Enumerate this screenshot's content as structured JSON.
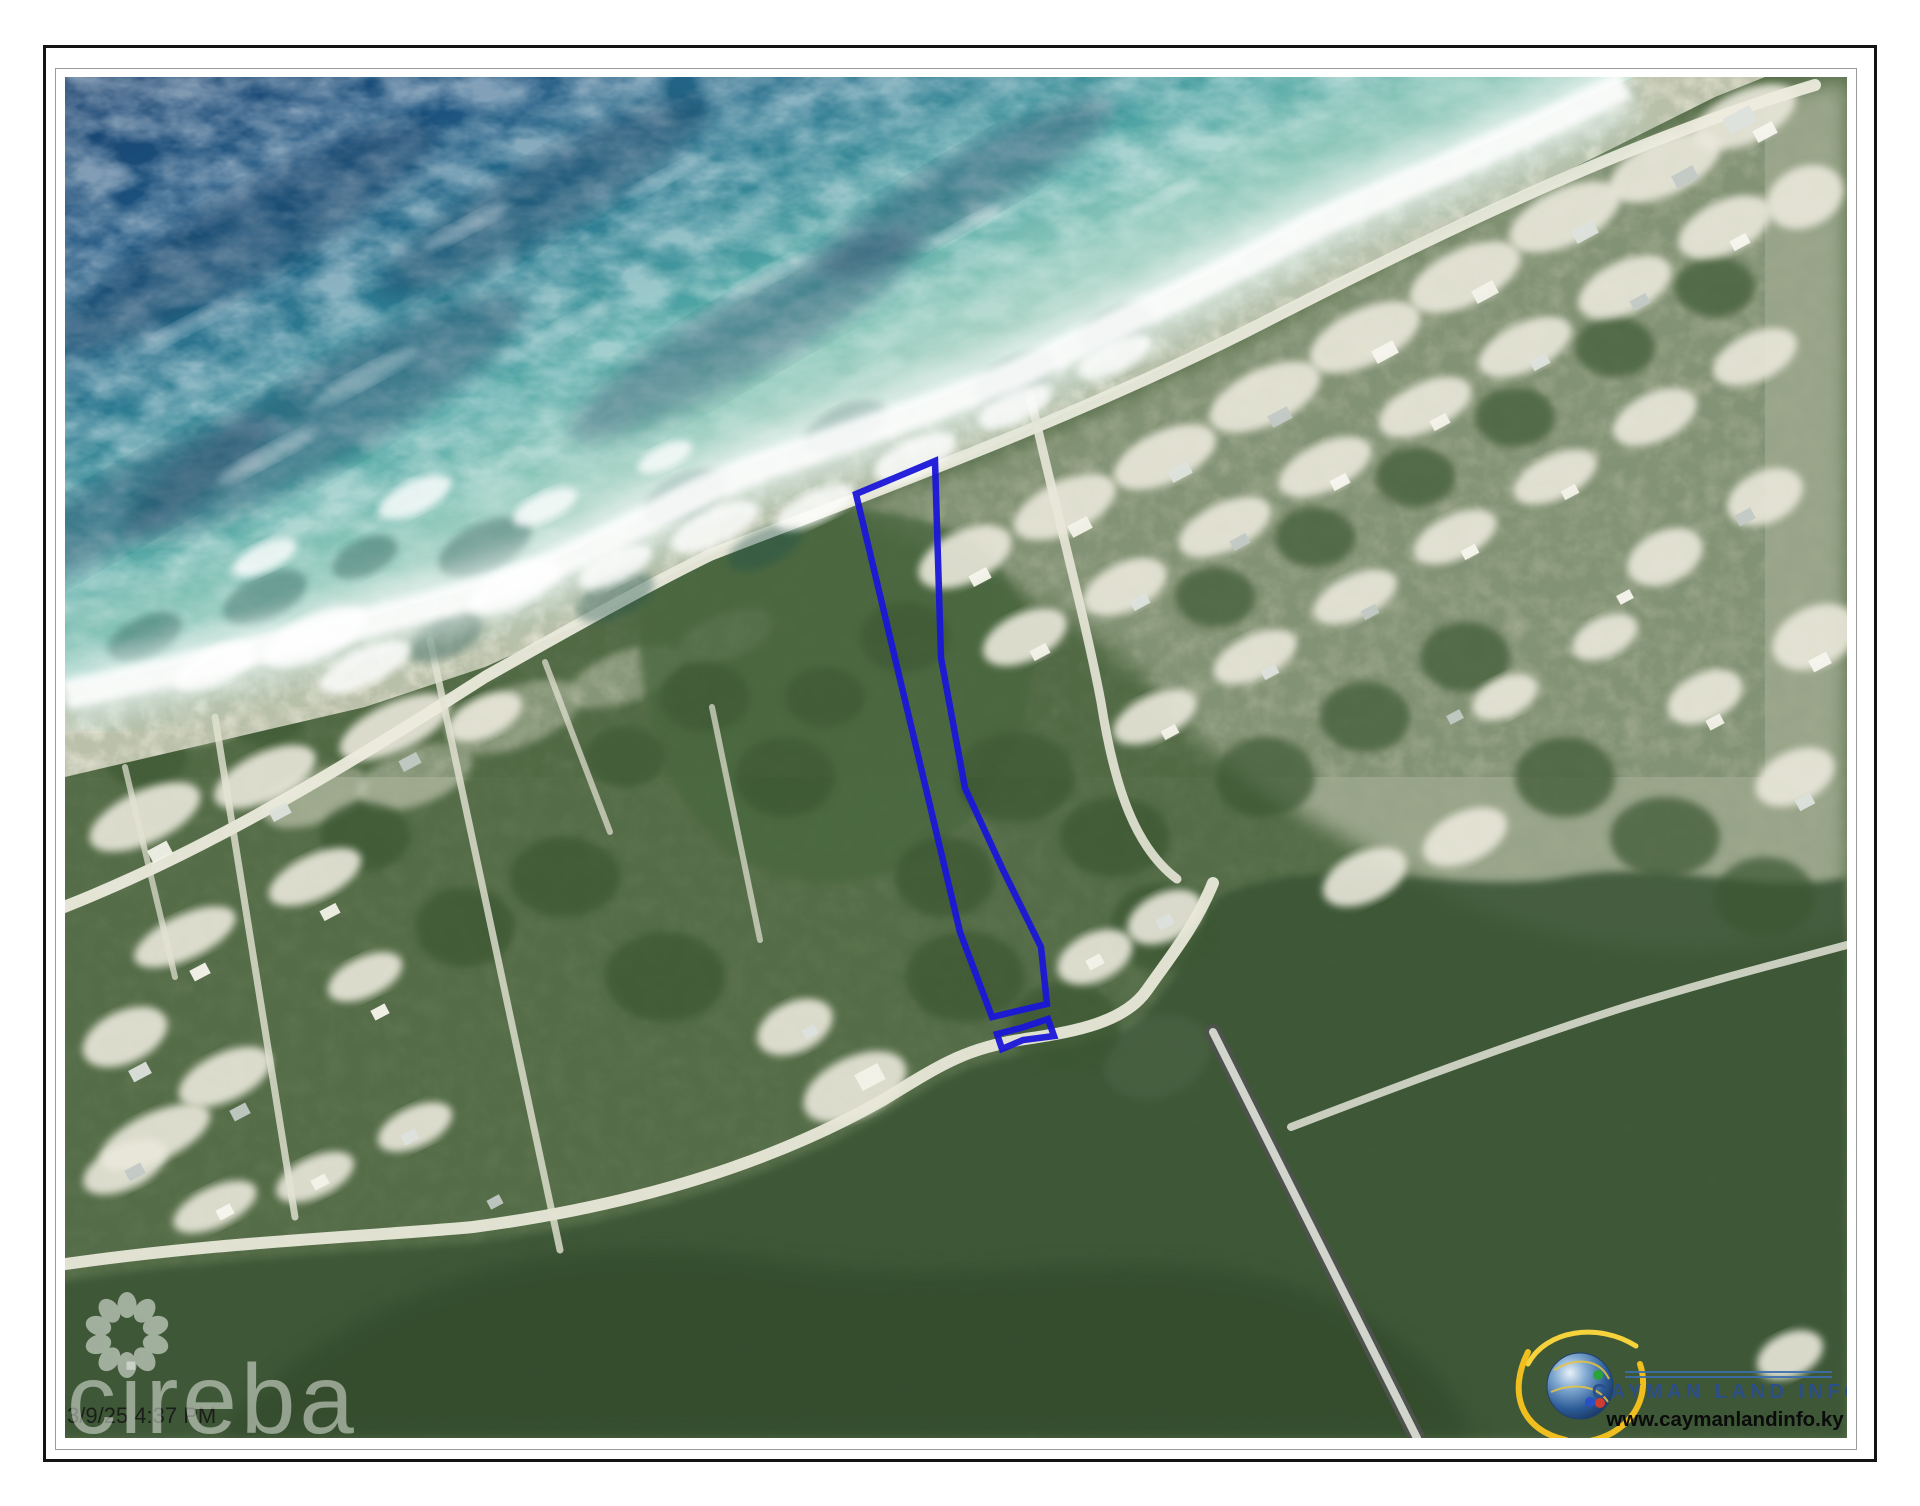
{
  "window": {
    "background": "#ffffff",
    "frame_color": "#141414"
  },
  "map": {
    "timestamp": "3/9/25 4:37 PM",
    "watermark": {
      "brand": "cireba"
    },
    "branding": {
      "name": "CAYMAN LAND INFO",
      "website": "www.caymanlandinfo.ky"
    },
    "parcel": {
      "outline_color": "#1a16d9",
      "main_points": "791,417 870,384 876,581 900,711 938,793 976,870 982,927 927,940 895,855",
      "annex_points": "932,957 956,951 983,942 989,959 958,963 937,972"
    }
  }
}
